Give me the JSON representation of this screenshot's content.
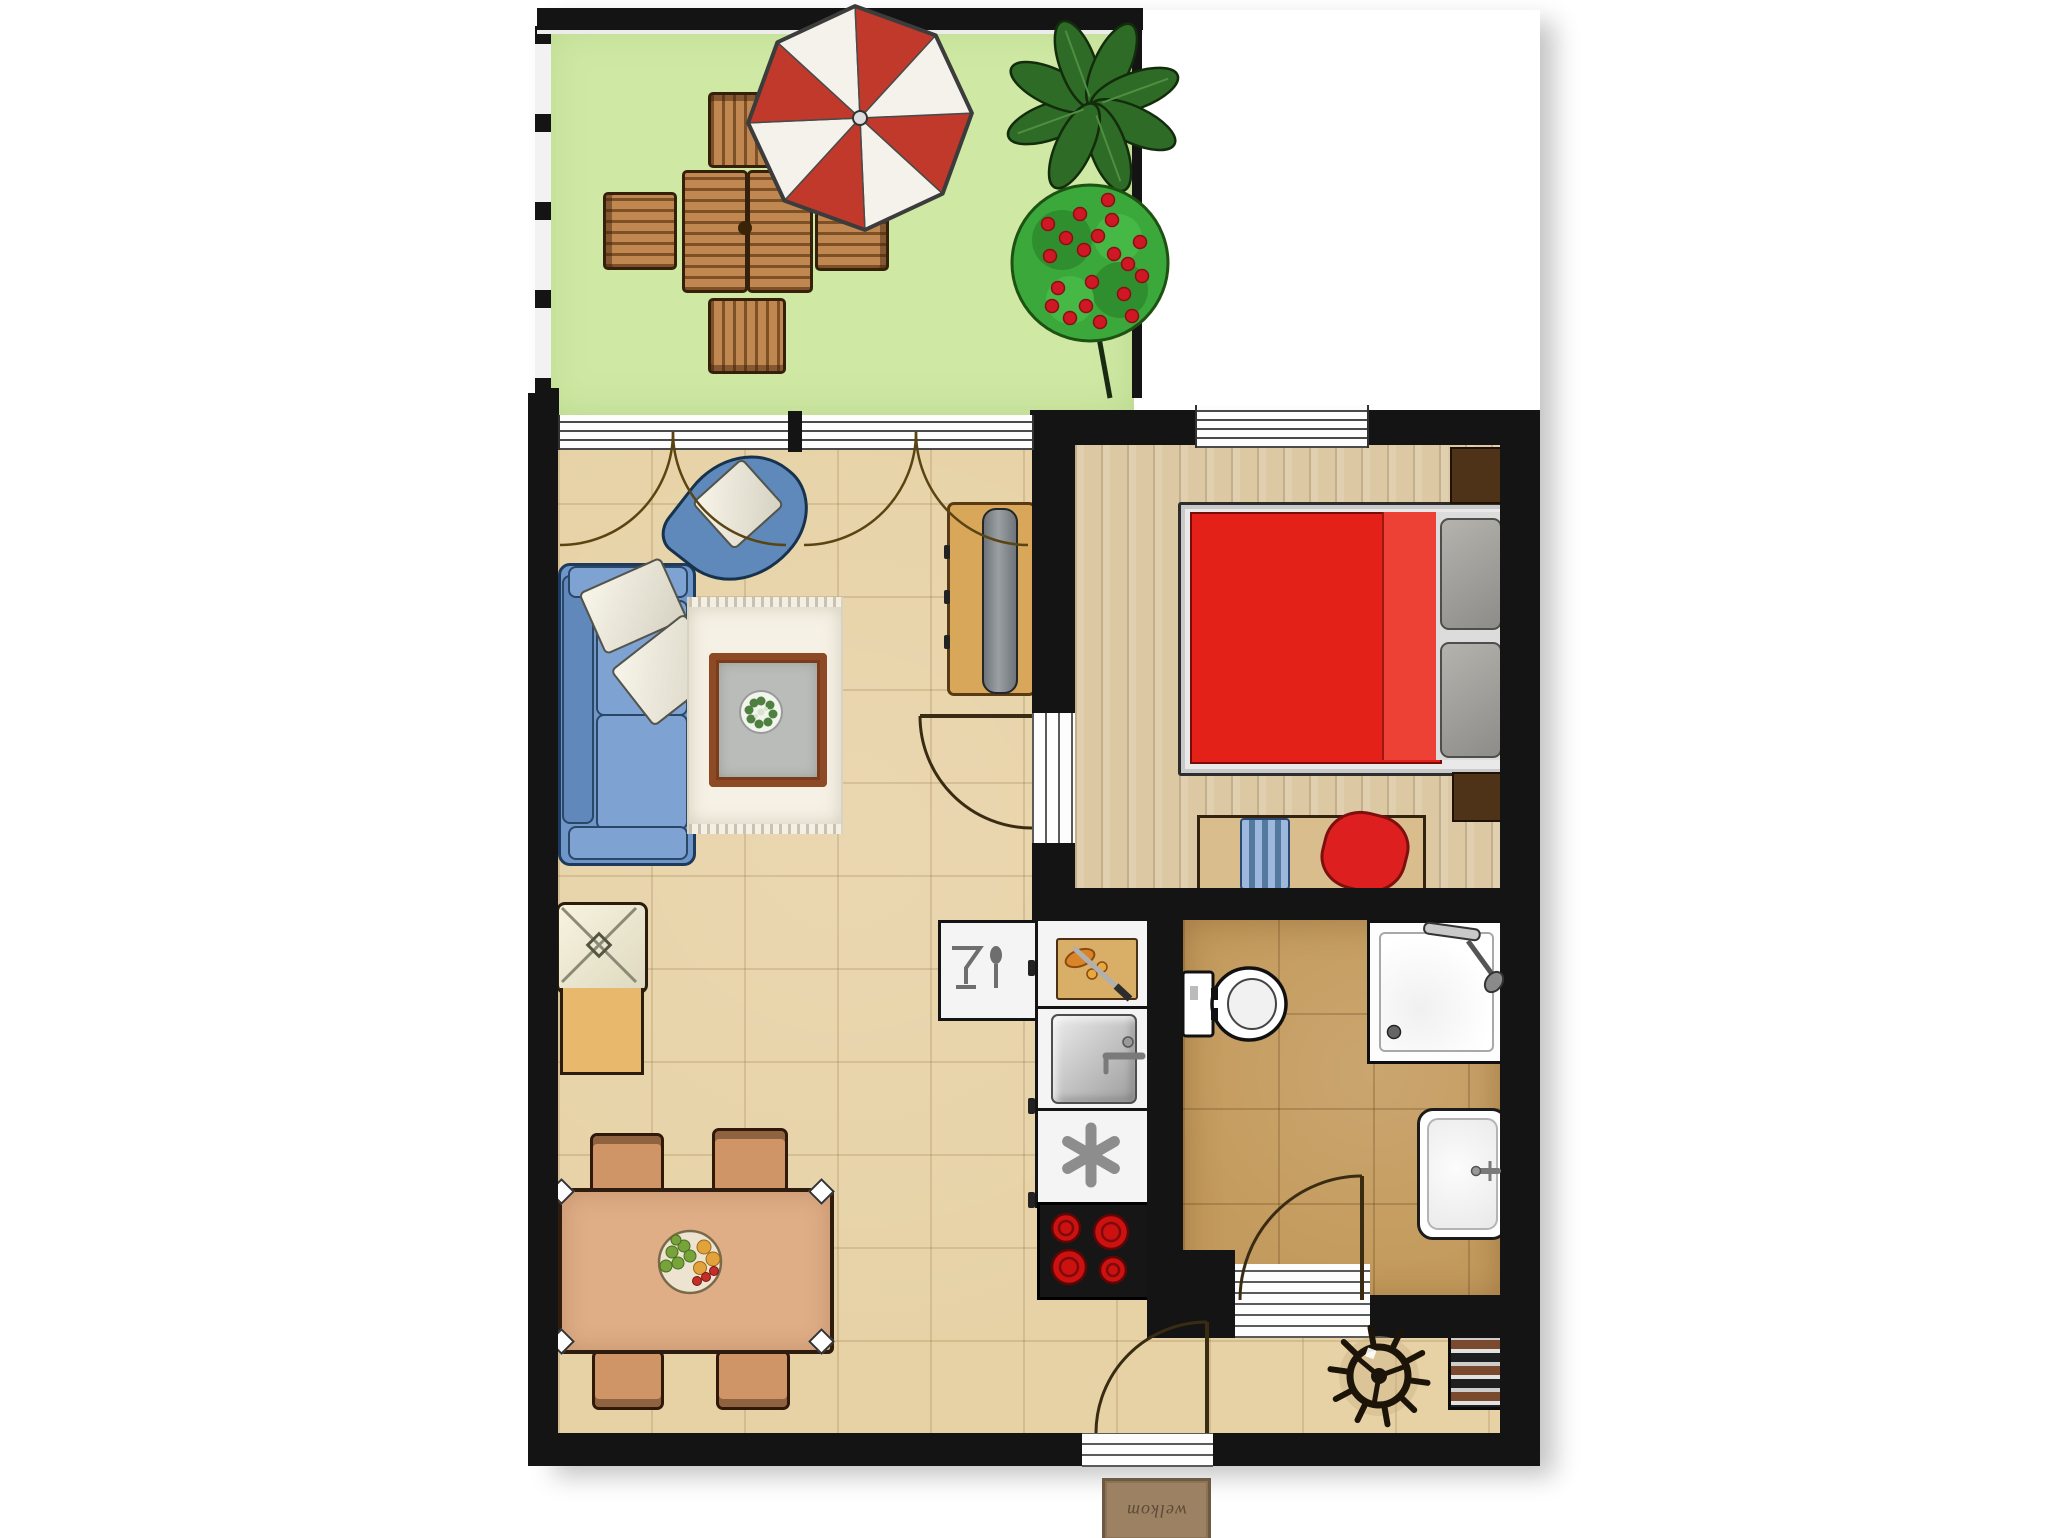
{
  "page": {
    "type": "apartment-floor-plan",
    "description": "Top-down floor plan of a one-bedroom apartment with terrace, living room with open kitchen, bedroom, bathroom and entrance hall"
  },
  "mat": {
    "text": "welkom"
  },
  "rooms": {
    "terrace": {
      "name": "terrace",
      "items": [
        "patio-table",
        "patio-chair-top",
        "patio-chair-left",
        "patio-chair-right",
        "patio-chair-bottom",
        "parasol",
        "leaf-plant",
        "flowering-bush"
      ]
    },
    "living_room": {
      "name": "living-room",
      "items": [
        "sofa",
        "throw-pillow",
        "throw-pillow",
        "armchair",
        "armchair-pillow",
        "rug",
        "coffee-table",
        "plant-bowl",
        "lounge-chair",
        "tv-sideboard",
        "tv",
        "dining-table",
        "dining-chair",
        "dining-chair",
        "dining-chair",
        "dining-chair",
        "fruit-bowl",
        "window-band",
        "curtain-arcs"
      ]
    },
    "kitchen": {
      "name": "kitchen",
      "items": [
        "dishwasher",
        "cutting-board-counter",
        "kitchen-sink",
        "freezer",
        "cooktop"
      ]
    },
    "bedroom": {
      "name": "bedroom",
      "items": [
        "double-bed",
        "bed-pillow",
        "bed-pillow",
        "nightstand",
        "nightstand",
        "bench",
        "blue-bag",
        "red-bag",
        "window"
      ]
    },
    "bathroom": {
      "name": "bathroom",
      "items": [
        "toilet",
        "shower",
        "washbasin",
        "door"
      ]
    },
    "hallway": {
      "name": "hallway",
      "items": [
        "helm-wheel-decor",
        "shoe-rack",
        "entrance-door",
        "welcome-mat"
      ]
    }
  },
  "colors": {
    "wall": "#141414",
    "terrace_floor": "#cfe9a4",
    "living_floor": "#e7d2a6",
    "bedroom_floor": "#dcc8a2",
    "bathroom_floor": "#c49b5e",
    "sofa_blue": "#6f96c9",
    "bed_red": "#e32119",
    "umbrella_red": "#c0392b",
    "bush_green": "#3aa83a",
    "wood": "#c08850"
  }
}
